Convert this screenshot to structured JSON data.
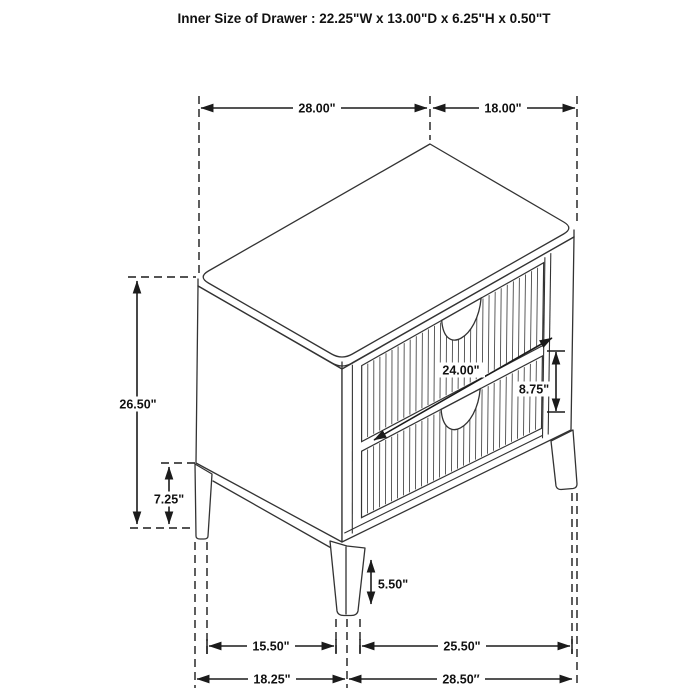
{
  "title": "Inner Size of Drawer : 22.25\"W x 13.00\"D x 6.25\"H x 0.50\"T",
  "figure": {
    "type": "furniture dimension diagram",
    "subject": "two-drawer nightstand, isometric line drawing"
  },
  "dimensions": {
    "top_width": "28.00\"",
    "top_depth": "18.00\"",
    "overall_height": "26.50\"",
    "leg_section_height": "7.25\"",
    "drawer_front_width": "24.00\"",
    "drawer_front_height": "8.75\"",
    "front_leg_height": "5.50\"",
    "base_inner_width": "15.50\"",
    "base_inner_depth": "25.50\"",
    "base_outer_width": "18.25\"",
    "base_outer_depth": "28.50″"
  },
  "colors": {
    "line": "#1b1b1b",
    "drawing": "#333333",
    "background": "#ffffff"
  }
}
